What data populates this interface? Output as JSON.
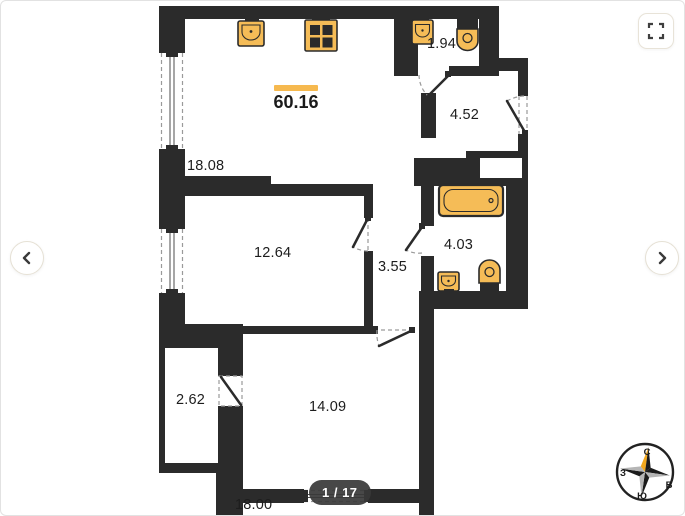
{
  "viewer": {
    "page_indicator": "1 / 17",
    "fullscreen_icon": "fullscreen-expand",
    "prev_icon": "chevron-left",
    "next_icon": "chevron-right"
  },
  "floorplan": {
    "total_area": "60.16",
    "rooms": [
      {
        "name": "living-kitchen",
        "area": "18.08"
      },
      {
        "name": "wc",
        "area": "1.94"
      },
      {
        "name": "entry-hall",
        "area": "4.52"
      },
      {
        "name": "room",
        "area": "12.64"
      },
      {
        "name": "corridor",
        "area": "3.55"
      },
      {
        "name": "bathroom",
        "area": "4.03"
      },
      {
        "name": "wardrobe",
        "area": "2.62"
      },
      {
        "name": "bedroom",
        "area": "14.09"
      },
      {
        "name": "room-lower",
        "area": "18.00"
      }
    ],
    "compass": {
      "north": "С",
      "east": "В",
      "south": "Ю",
      "west": "З"
    }
  },
  "colors": {
    "accent": "#f6b94f",
    "fixture": "#f5bc57",
    "wall": "#2b2b2b",
    "badge_bg": "#383838"
  }
}
